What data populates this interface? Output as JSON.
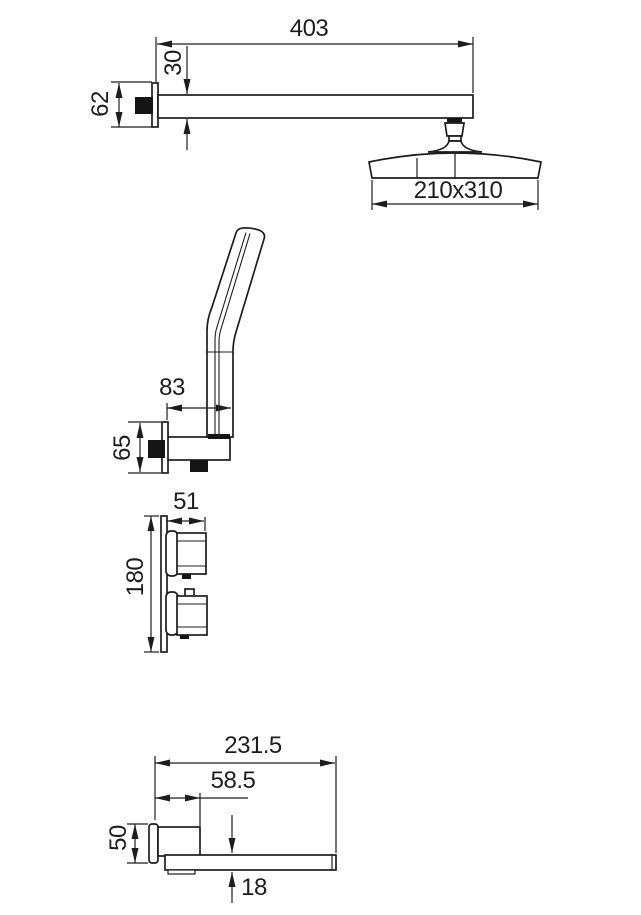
{
  "drawing": {
    "kind": "technical-dimension-drawing",
    "background": "#ffffff",
    "line_color": "#1d1d1d",
    "sections": {
      "shower_arm": {
        "dims": {
          "arm_length": "403",
          "arm_height": "30",
          "flange_height": "62",
          "head_size": "210x310"
        }
      },
      "hand_shower": {
        "dims": {
          "holder_reach": "83",
          "holder_height": "65"
        }
      },
      "mixer_valve": {
        "dims": {
          "handle_depth": "51",
          "plate_height": "180"
        }
      },
      "spout": {
        "dims": {
          "total_length": "231.5",
          "wall_block_length": "58.5",
          "flange_height": "50",
          "blade_thickness": "18"
        }
      }
    }
  }
}
